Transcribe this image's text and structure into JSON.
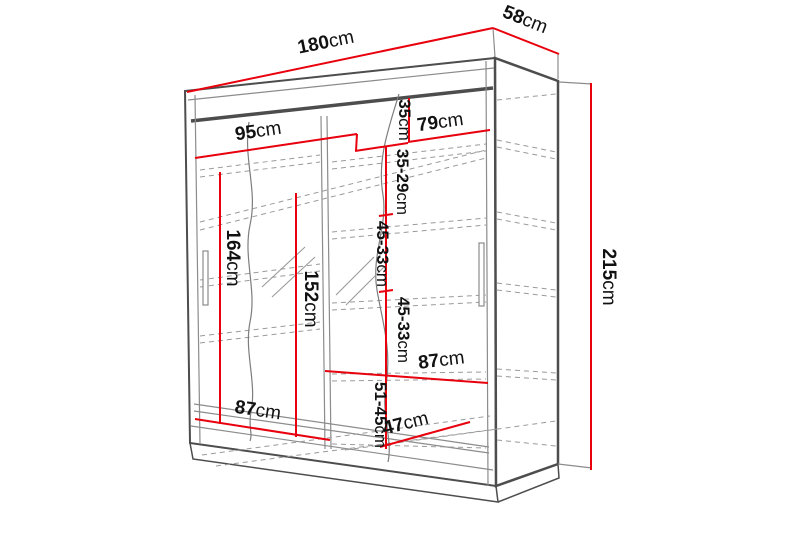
{
  "diagram": {
    "kind": "furniture-dimension-diagram",
    "subject": "sliding-door mirrored wardrobe",
    "unit": "cm",
    "colors": {
      "dimension_line": "#e8000d",
      "structure_edge": "#4d4d4d",
      "hidden_edge": "#9a9a9a",
      "label_text": "#111111",
      "background": "#ffffff"
    }
  },
  "dimensions": [
    {
      "id": "width-total",
      "value": "180",
      "unit": "cm"
    },
    {
      "id": "depth-total",
      "value": "58",
      "unit": "cm"
    },
    {
      "id": "height-total",
      "value": "215",
      "unit": "cm"
    },
    {
      "id": "left-section-width",
      "value": "95",
      "unit": "cm"
    },
    {
      "id": "right-section-width",
      "value": "79",
      "unit": "cm"
    },
    {
      "id": "top-shelf-space",
      "value": "35",
      "unit": "cm"
    },
    {
      "id": "shelf-space-1",
      "value": "35-29",
      "unit": "cm"
    },
    {
      "id": "shelf-space-2",
      "value": "45-33",
      "unit": "cm"
    },
    {
      "id": "shelf-space-3",
      "value": "45-33",
      "unit": "cm"
    },
    {
      "id": "bottom-shelf-space",
      "value": "51-45",
      "unit": "cm"
    },
    {
      "id": "hanging-height-left",
      "value": "164",
      "unit": "cm"
    },
    {
      "id": "inner-height-left",
      "value": "152",
      "unit": "cm"
    },
    {
      "id": "bottom-width-left",
      "value": "87",
      "unit": "cm"
    },
    {
      "id": "shelf-width-right",
      "value": "87",
      "unit": "cm"
    },
    {
      "id": "inner-depth",
      "value": "47",
      "unit": "cm"
    }
  ]
}
